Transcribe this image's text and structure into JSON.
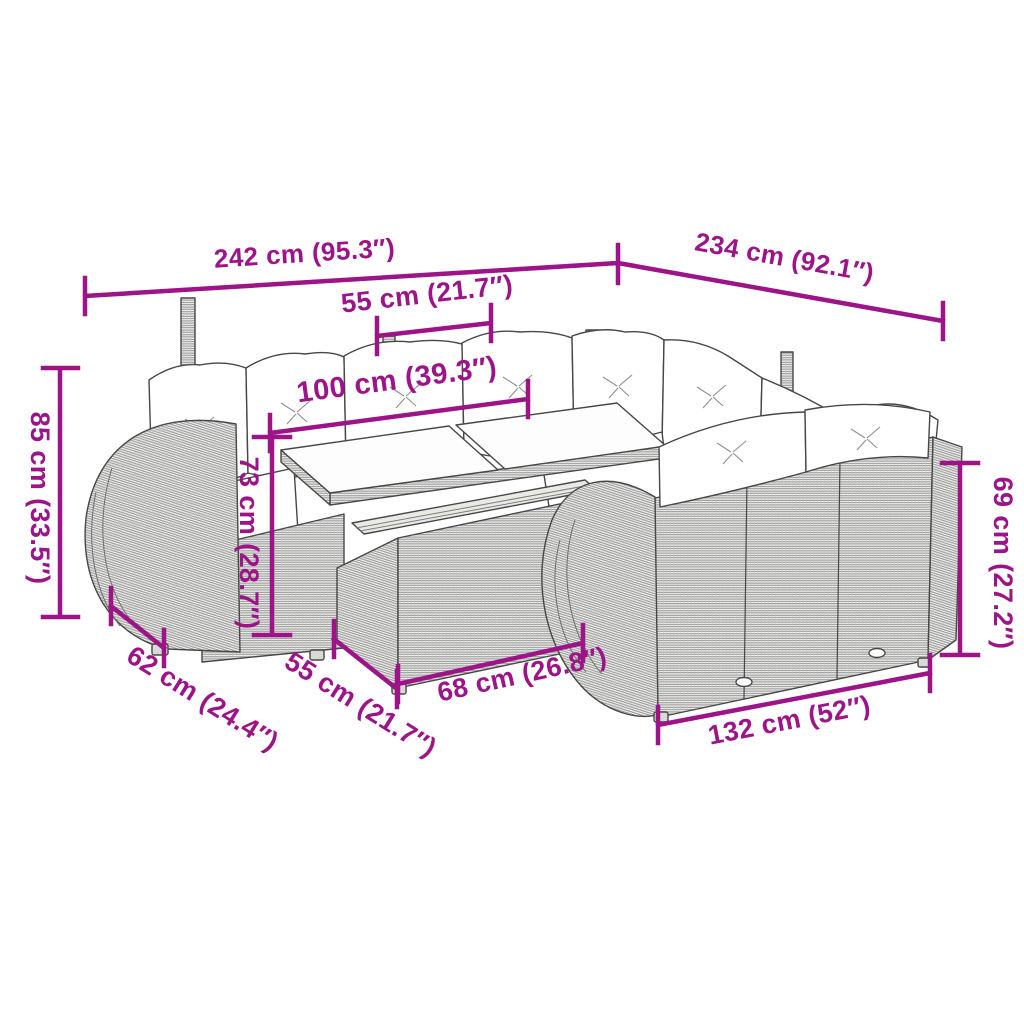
{
  "diagram": {
    "accent_color": "#9C1487",
    "line_art_color": "#474747",
    "dims": {
      "d242": "242 cm (95.3″)",
      "d234": "234 cm (92.1″)",
      "d55_top": "55 cm (21.7″)",
      "d100": "100 cm (39.3″)",
      "d85": "85 cm (33.5″)",
      "d73": "73 cm (28.7″)",
      "d69": "69 cm (27.2″)",
      "d62": "62 cm (24.4″)",
      "d55_bottom": "55 cm (21.7″)",
      "d68": "68 cm (26.8″)",
      "d132": "132 cm (52″)"
    }
  }
}
